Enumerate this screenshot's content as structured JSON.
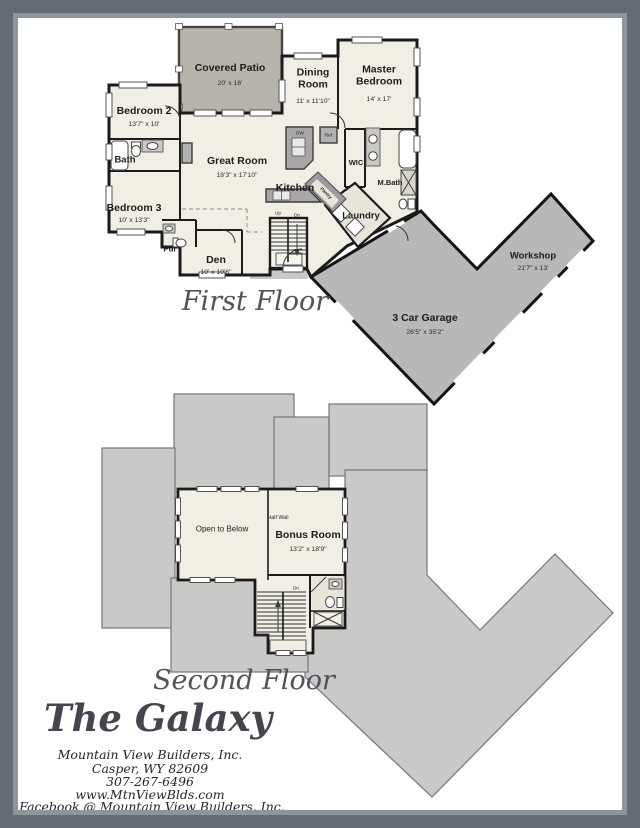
{
  "document": {
    "type": "architectural floor plan sheet"
  },
  "title_block": {
    "plan_name": "The Galaxy",
    "company": "Mountain View Builders, Inc.",
    "address": "Casper, WY 82609",
    "phone": "307-267-6496",
    "website": "www.MtnViewBlds.com",
    "social": "Facebook @ Mountain View Builders, Inc."
  },
  "first_floor": {
    "label": "First Floor",
    "rooms": {
      "covered_patio": {
        "name": "Covered Patio",
        "dims": "20' x 16'"
      },
      "dining_room": {
        "name": "Dining\nRoom",
        "dims": "11' x 11'10\""
      },
      "master_bedroom": {
        "name": "Master\nBedroom",
        "dims": "14' x 17'"
      },
      "bedroom_2": {
        "name": "Bedroom 2",
        "dims": "13'7\" x 10'"
      },
      "bath": {
        "name": "Bath"
      },
      "great_room": {
        "name": "Great Room",
        "dims": "18'3\" x 17'10\""
      },
      "kitchen": {
        "name": "Kitchen"
      },
      "wic": {
        "name": "WIC"
      },
      "m_bath": {
        "name": "M.Bath"
      },
      "bedroom_3": {
        "name": "Bedroom 3",
        "dims": "10' x 13'3\""
      },
      "pdr": {
        "name": "Pdr"
      },
      "den": {
        "name": "Den",
        "dims": "10' x 10'6\""
      },
      "laundry": {
        "name": "Laundry"
      },
      "pantry": {
        "name": "Pantry"
      },
      "garage": {
        "name": "3 Car Garage",
        "dims": "26'5\" x 35'2\""
      },
      "workshop": {
        "name": "Workshop",
        "dims": "21'7\" x 13'"
      }
    },
    "annotations": {
      "up": "Up",
      "down": "Dn",
      "fridge": "Ref",
      "dishwasher": "DW"
    }
  },
  "second_floor": {
    "label": "Second Floor",
    "rooms": {
      "open_to_below": {
        "name": "Open to Below"
      },
      "bonus_room": {
        "name": "Bonus Room",
        "dims": "13'2\" x 18'9\""
      },
      "half_wall": {
        "name": "Half Wall"
      }
    },
    "annotations": {
      "down": "Dn"
    }
  },
  "colors": {
    "wall": "#1b1b1b",
    "floor": "#f1efe4",
    "tile": "#e8e5d8",
    "patio_gray": "#b7b4ac",
    "garage_gray": "#b9b7b8",
    "roof_gray": "#cbc8c8",
    "roof_border": "#76747b",
    "frame_outer": "#646b71",
    "frame_inner": "#8f969b",
    "script_text": "#52525c"
  }
}
